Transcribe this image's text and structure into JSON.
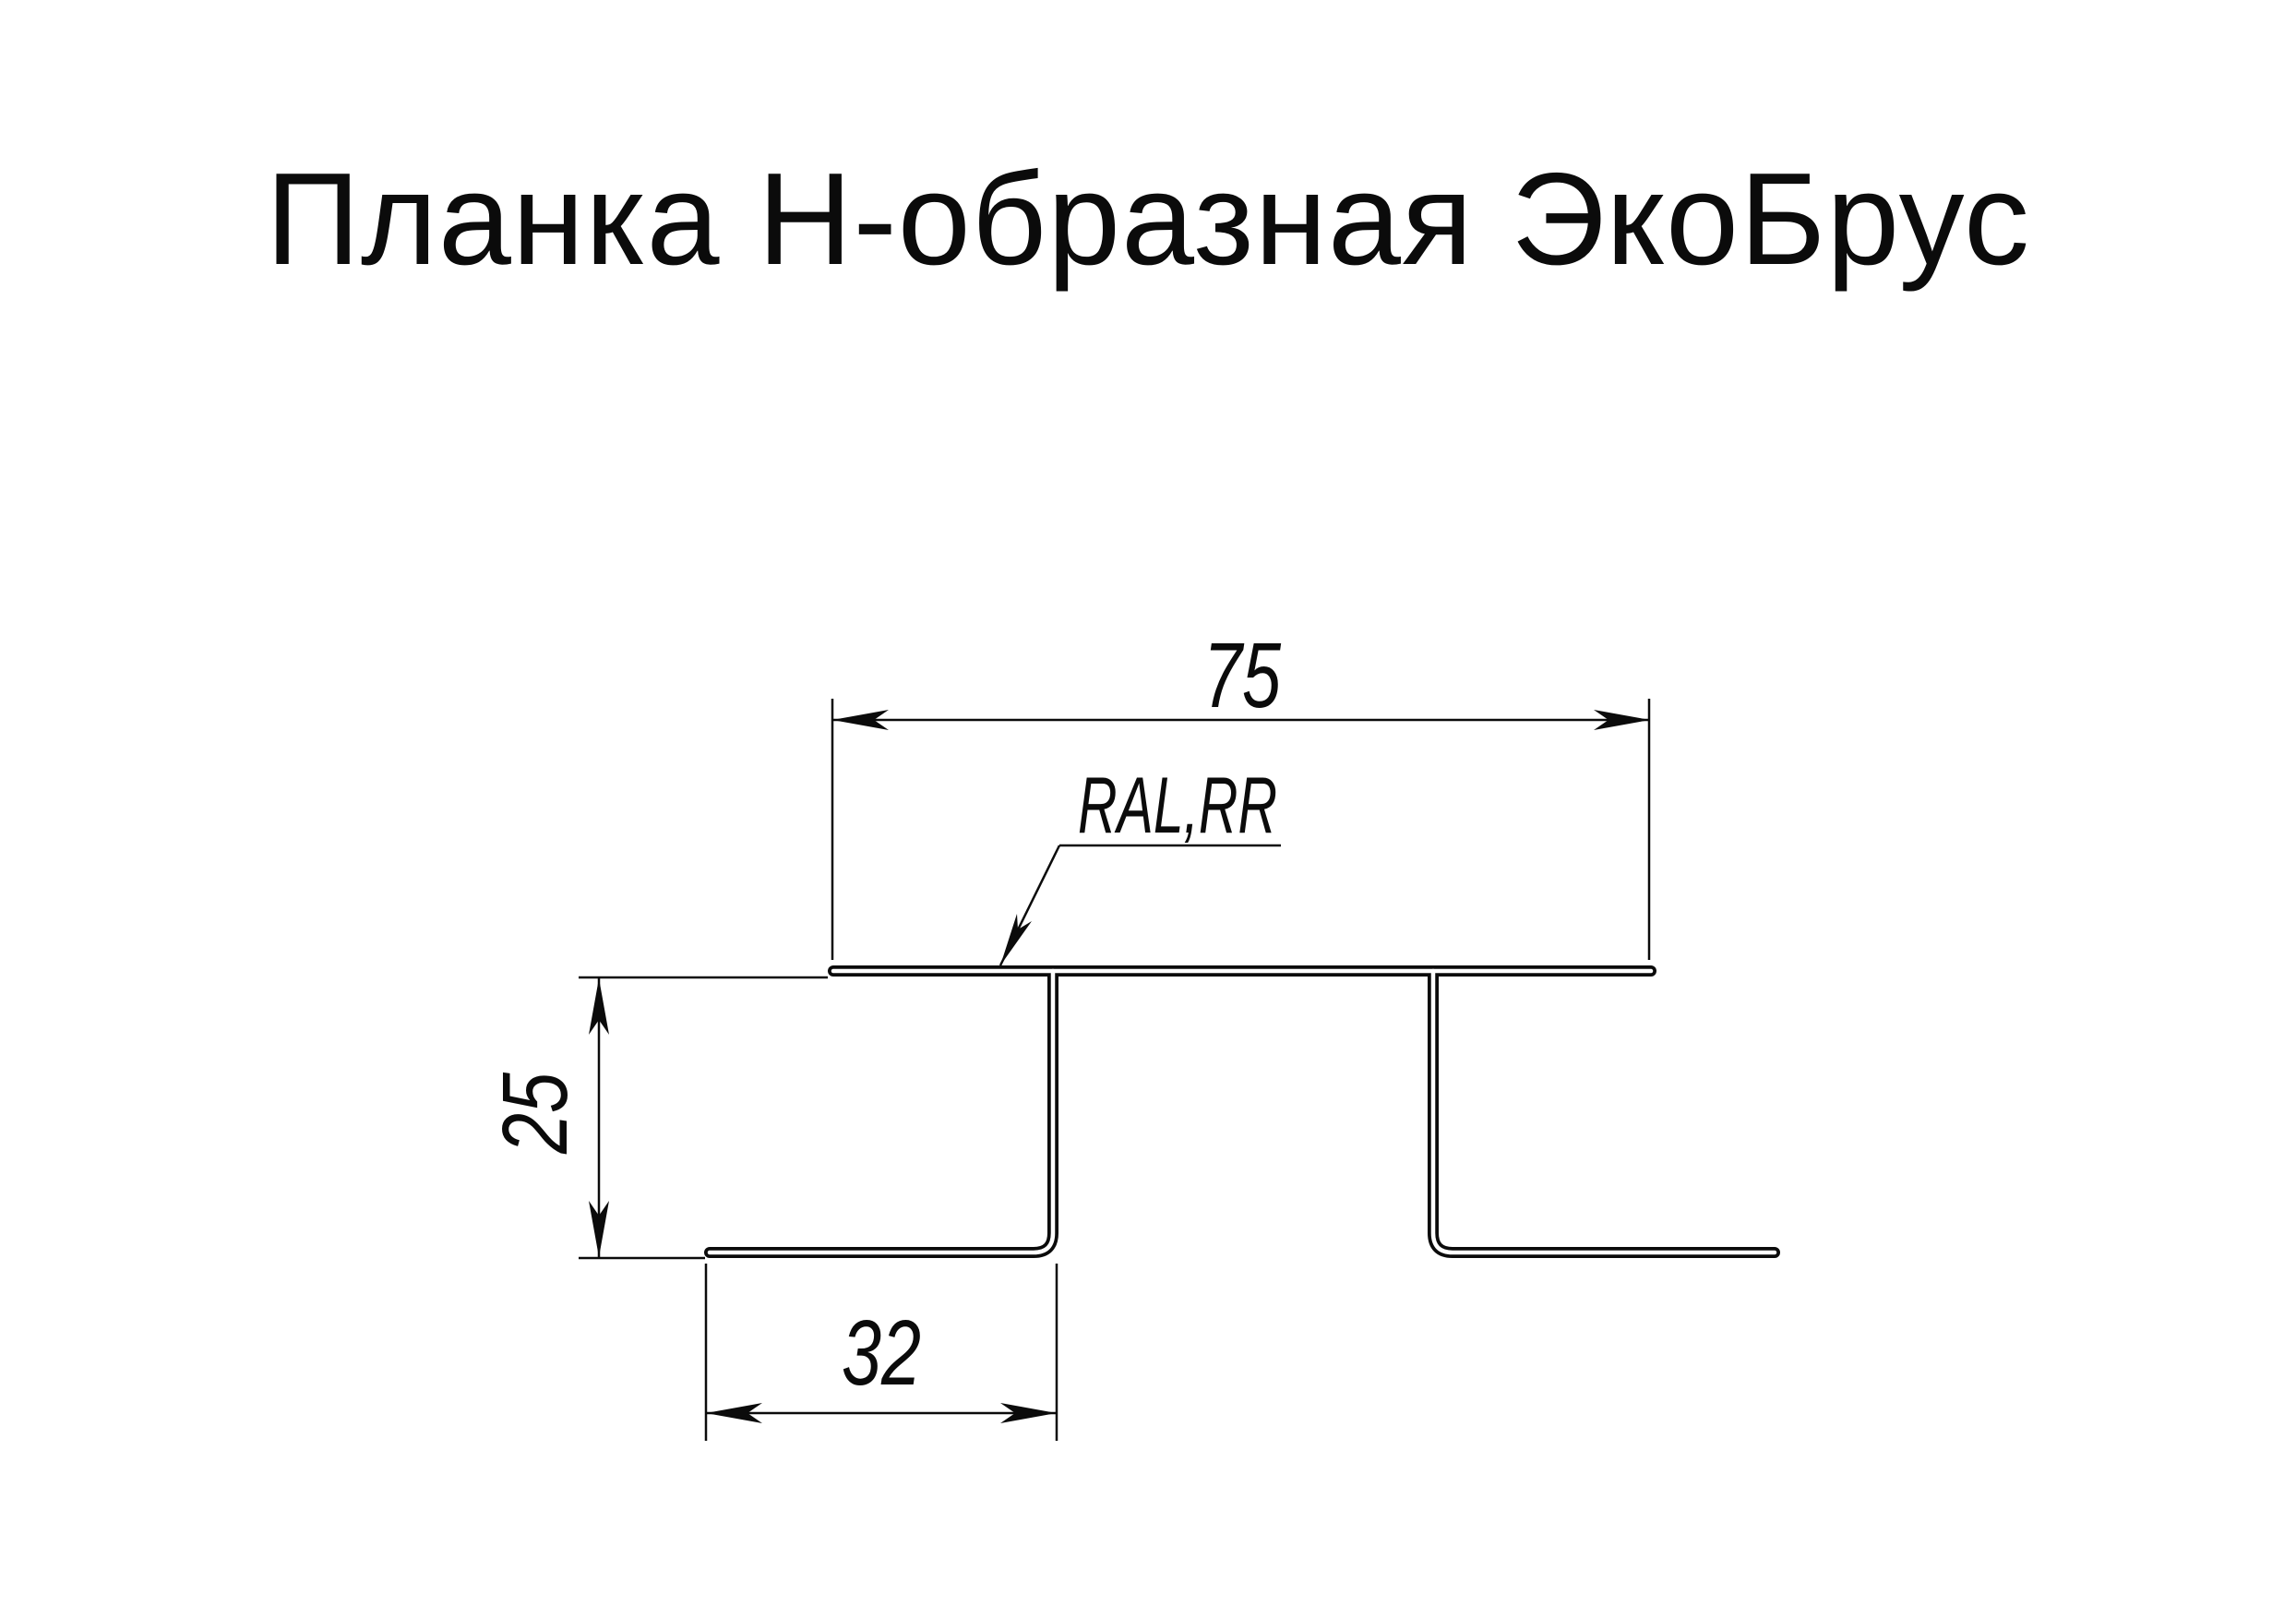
{
  "page": {
    "background_color": "#ffffff",
    "ink_color": "#0b0b0b"
  },
  "title": {
    "text": "Планка Н-образная ЭкоБрус"
  },
  "drawing": {
    "type": "technical cross-section of H-shaped joint strip",
    "coating_label": "RAL,RR",
    "dimensions": {
      "top_width": "75",
      "side_height": "25",
      "foot_width": "32"
    }
  }
}
